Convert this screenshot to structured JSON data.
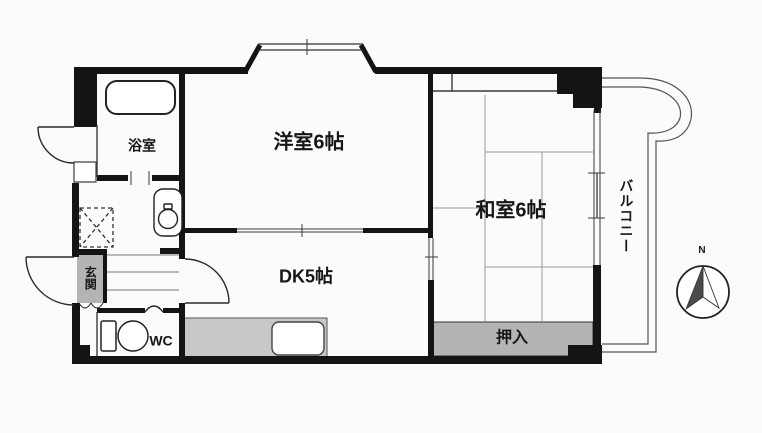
{
  "title": "apartment-floor-plan",
  "rooms": {
    "bath": {
      "label": "浴室"
    },
    "western_room": {
      "label": "洋室6帖"
    },
    "japanese_room": {
      "label": "和室6帖"
    },
    "dining_kitchen": {
      "label": "DK5帖"
    },
    "entrance": {
      "label": "玄関"
    },
    "toilet": {
      "label": "WC"
    },
    "closet": {
      "label": "押入"
    },
    "balcony": {
      "label": "バルコニー"
    }
  },
  "compass": {
    "north_label": "N"
  },
  "colors": {
    "wall": "#141414",
    "thin_line": "#3a3a3a",
    "tatami_line": "#999999",
    "fill_gray": "#b4b4b4",
    "counter_gray": "#c8c8c8",
    "paper": "#fbfbf9"
  }
}
